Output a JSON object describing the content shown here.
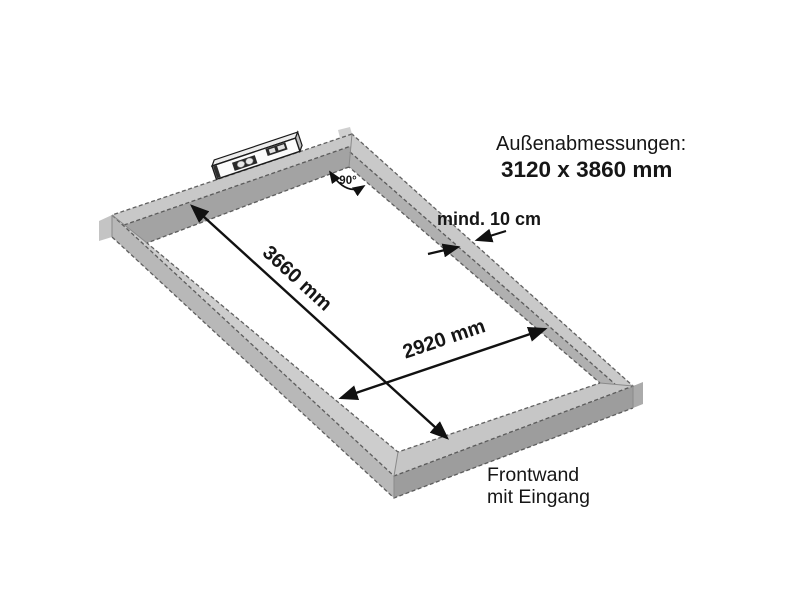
{
  "diagram": {
    "heading": {
      "label": "Außenabmessungen:",
      "value": "3120 x 3860 mm"
    },
    "dimensions": {
      "inner_length": "3660 mm",
      "inner_width": "2920 mm",
      "min_beam_width": "mind. 10 cm",
      "corner_angle": "90°"
    },
    "labels": {
      "front_line1": "Frontwand",
      "front_line2": "mit Eingang"
    },
    "colors": {
      "frame_top": "#c9c9c9",
      "frame_inner_side": "#a3a3a3",
      "frame_outer_side_left": "#b8b8b8",
      "frame_outer_side_front": "#9d9d9d",
      "edge_line": "#4a4a4a",
      "arrow": "#111111",
      "background": "#ffffff"
    }
  }
}
